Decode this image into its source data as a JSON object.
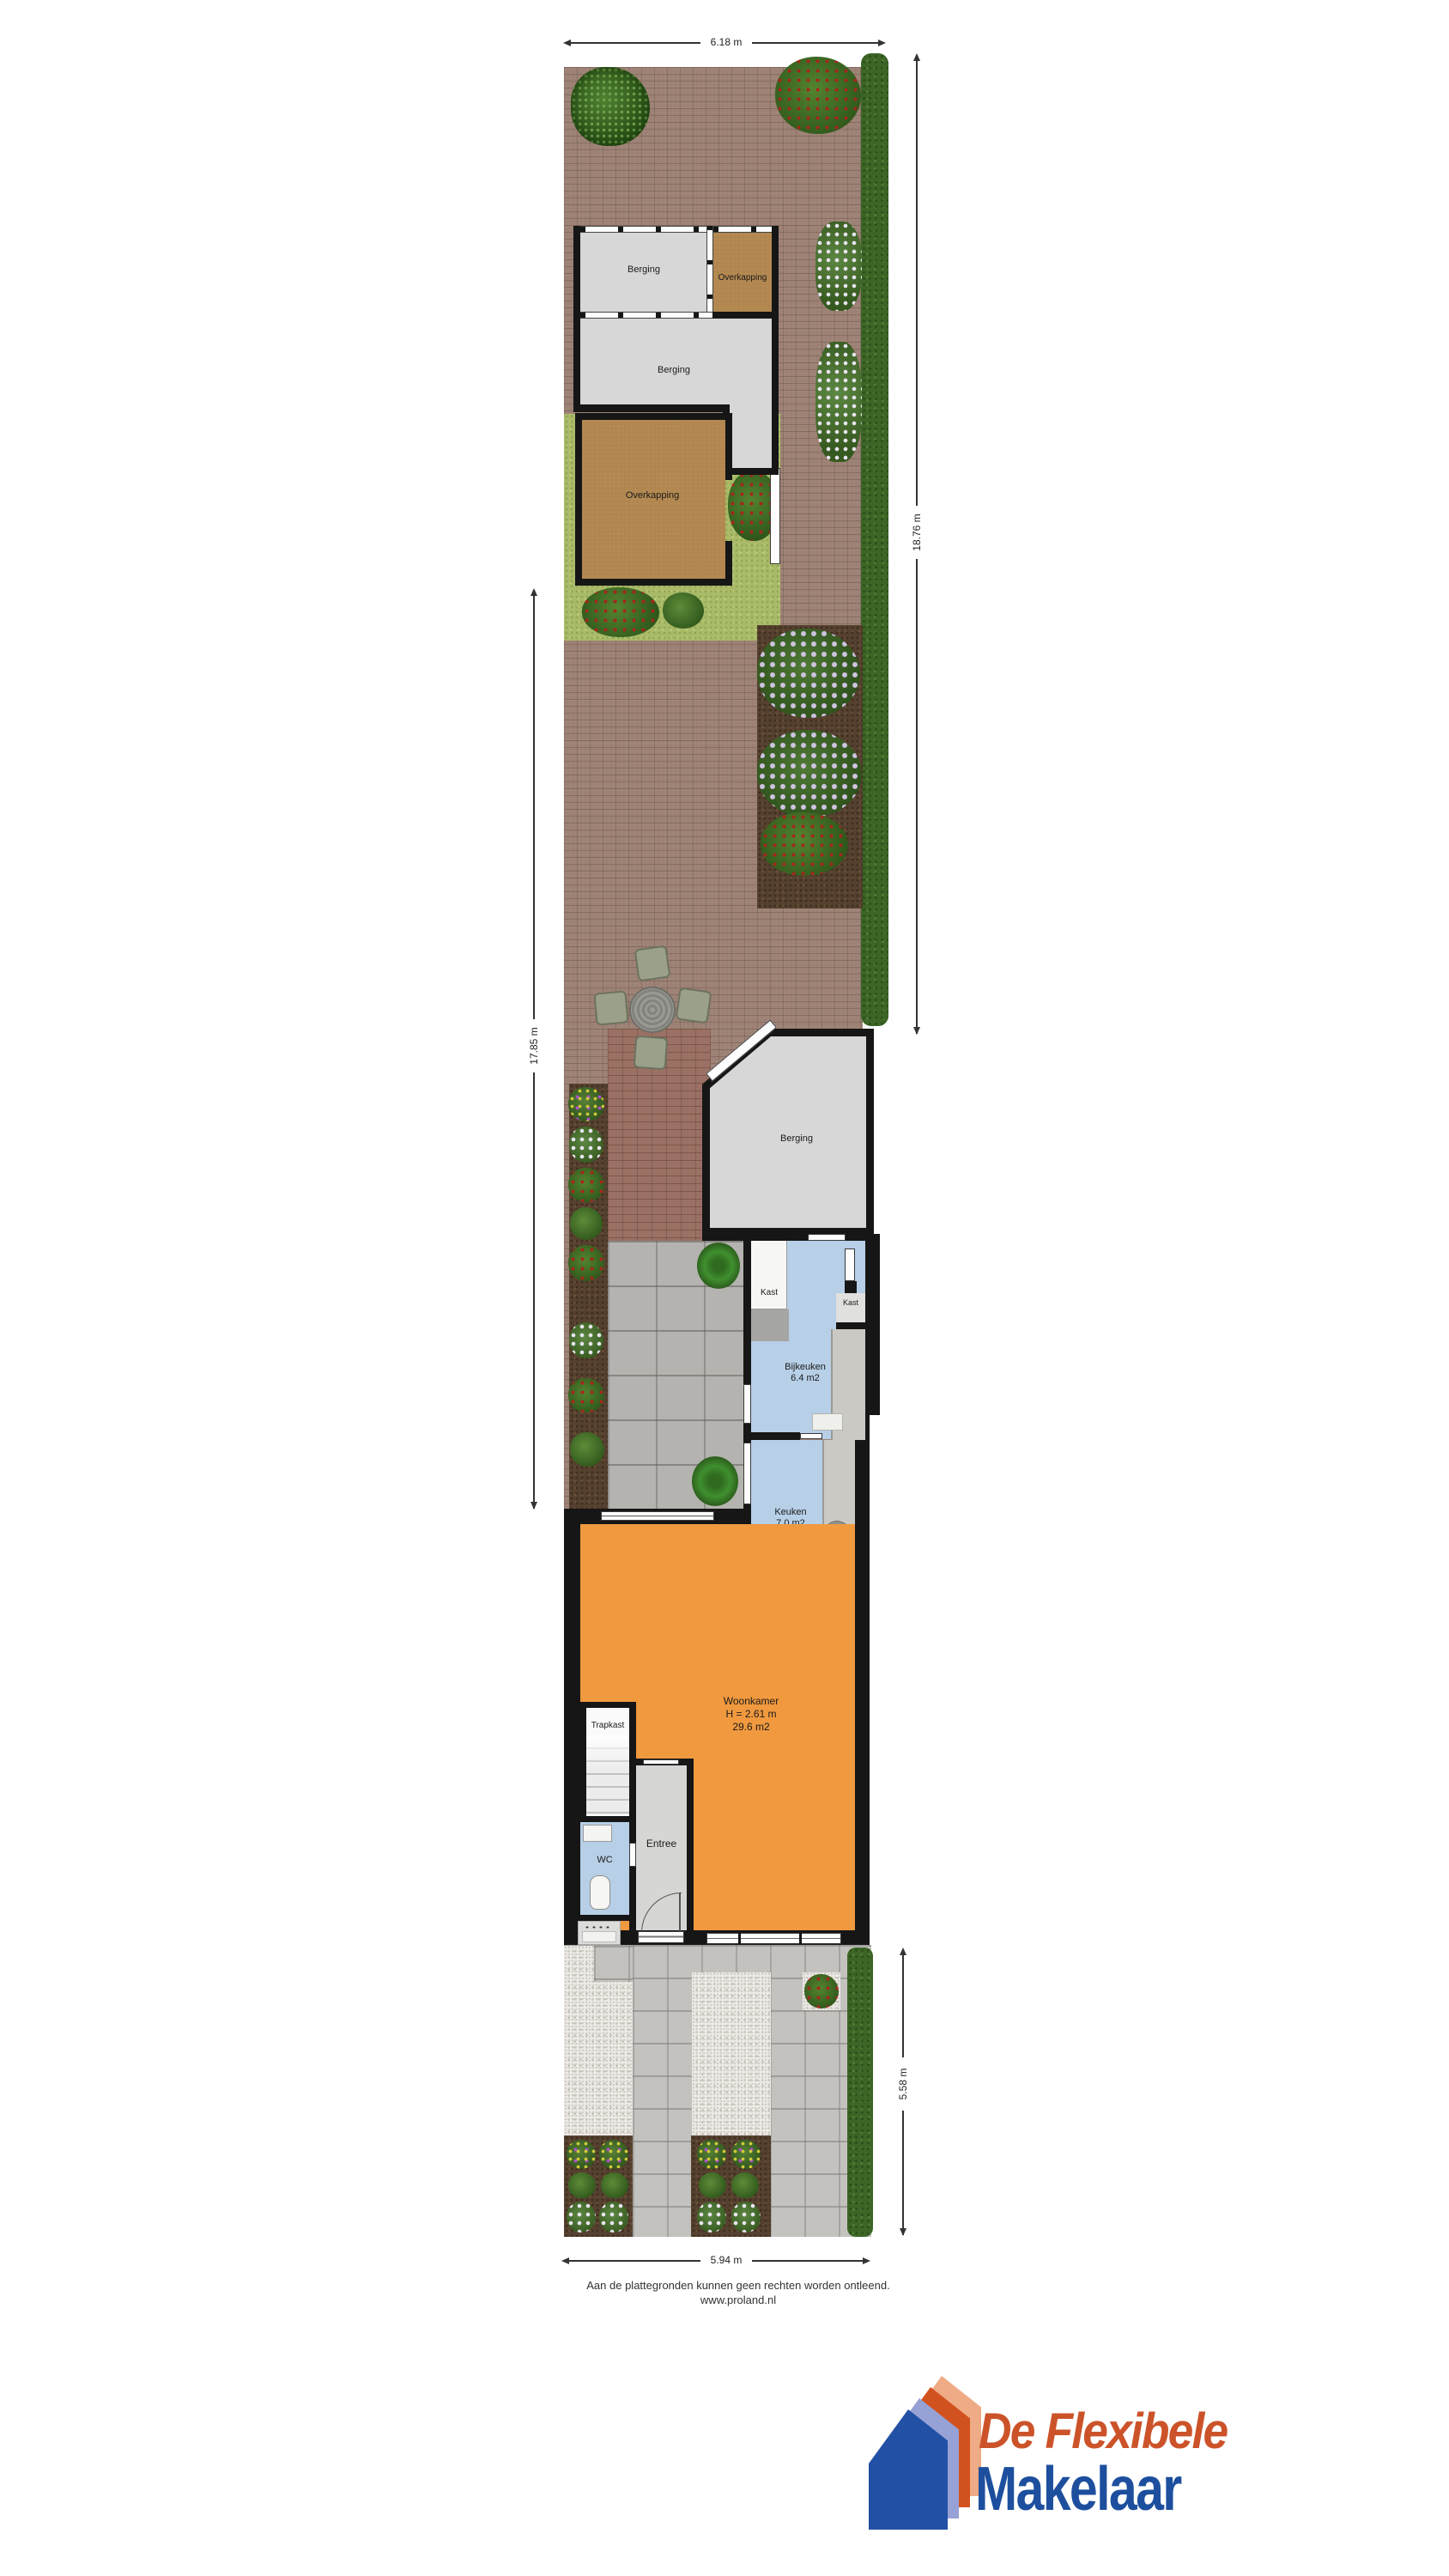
{
  "rooms": {
    "berging_top": {
      "label": "Berging"
    },
    "overkapping_top": {
      "label": "Overkapping"
    },
    "berging_mid": {
      "label": "Berging"
    },
    "overkapping_big": {
      "label": "Overkapping"
    },
    "berging_rear": {
      "label": "Berging"
    },
    "kast1": {
      "label": "Kast"
    },
    "kast2": {
      "label": "Kast"
    },
    "bijkeuken": {
      "name": "Bijkeuken",
      "area": "6.4 m2"
    },
    "keuken": {
      "name": "Keuken",
      "area": "7.0 m2"
    },
    "woonkamer": {
      "name": "Woonkamer",
      "height": "H = 2.61 m",
      "area": "29.6 m2"
    },
    "trapkast": {
      "label": "Trapkast"
    },
    "wc": {
      "label": "WC"
    },
    "entree": {
      "label": "Entree"
    }
  },
  "dimensions": {
    "top": "6.18 m",
    "right_upper": "18.76 m",
    "left": "17.85 m",
    "right_lower": "5.58 m",
    "bottom": "5.94 m"
  },
  "footer": {
    "disclaimer": "Aan de plattegronden kunnen geen rechten worden ontleend.",
    "website": "www.proland.nl"
  },
  "logo": {
    "line1": "De Flexibele",
    "line2": "Makelaar",
    "accent_orange": "#cc5329",
    "accent_blue": "#1d4f9e"
  }
}
